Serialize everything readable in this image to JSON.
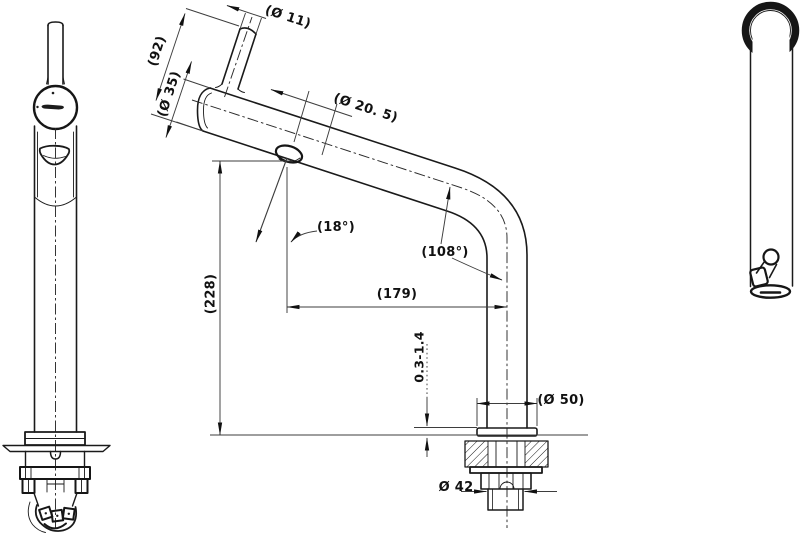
{
  "colors": {
    "background": "#ffffff",
    "ink": "#1a1a1a",
    "dim_line": "#3d3d3d"
  },
  "dimensions": {
    "tip_diameter": "(Ø 11)",
    "lever_height": "(92)",
    "body_diameter": "(Ø 35)",
    "spout_tube_diameter": "(Ø 20. 5)",
    "spout_angle": "(18°)",
    "bend_angle": "(108°)",
    "height_above_deck": "(228)",
    "spout_reach": "(179)",
    "deck_clamp_range": "0.3-1.4",
    "flange_diameter": "(Ø 50)",
    "shank_diameter": "Ø 42"
  }
}
